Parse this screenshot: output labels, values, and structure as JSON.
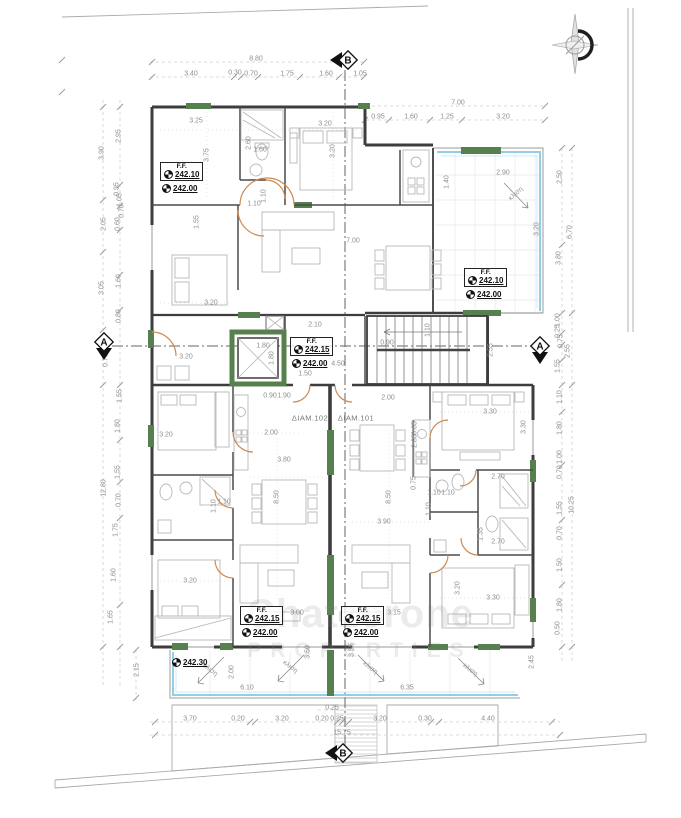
{
  "watermark": {
    "line1": "Chatzerone",
    "line2": "PROPERTIES"
  },
  "colors": {
    "wall": "#3d3d3d",
    "green_wall": "#57804f",
    "balcony_glass": "#8fd0e8",
    "door_arc": "#cc8a52",
    "dim_text": "#8d8d8d"
  },
  "section_markers": [
    {
      "label": "B",
      "x": 345,
      "y": 60,
      "dir": "left"
    },
    {
      "label": "B",
      "x": 340,
      "y": 753,
      "dir": "left"
    },
    {
      "label": "A",
      "x": 104,
      "y": 345,
      "dir": "down"
    },
    {
      "label": "A",
      "x": 540,
      "y": 349,
      "dir": "down"
    }
  ],
  "elevations": [
    {
      "title": "F.F.",
      "value": "242.10",
      "sub": "242.00",
      "x": 160,
      "y": 162
    },
    {
      "title": "F.F.",
      "value": "242.10",
      "sub": "242.00",
      "x": 464,
      "y": 268
    },
    {
      "title": "F.F.",
      "value": "242.15",
      "sub": "242.00",
      "x": 290,
      "y": 337
    },
    {
      "title": "F.F.",
      "value": "242.15",
      "sub": "242.00",
      "x": 240,
      "y": 606
    },
    {
      "title": "F.F.",
      "value": "242.15",
      "sub": "242.00",
      "x": 341,
      "y": 606
    },
    {
      "title": "",
      "value": "242.30",
      "sub": "",
      "x": 170,
      "y": 658
    }
  ],
  "slope_labels": [
    {
      "t": "κλιση",
      "x": 516,
      "y": 194,
      "r": -42
    },
    {
      "t": "κλιση",
      "x": 210,
      "y": 670,
      "r": 38
    },
    {
      "t": "κλιση",
      "x": 290,
      "y": 667,
      "r": 38
    },
    {
      "t": "κλιση",
      "x": 370,
      "y": 668,
      "r": 38
    },
    {
      "t": "κλιση",
      "x": 470,
      "y": 670,
      "r": 38
    }
  ],
  "labels": [
    {
      "t": "8.80",
      "x": 256,
      "y": 59
    },
    {
      "t": "3.40",
      "x": 191,
      "y": 74
    },
    {
      "t": "0.30",
      "x": 235,
      "y": 73
    },
    {
      "t": "0.70",
      "x": 251,
      "y": 74
    },
    {
      "t": "1.75",
      "x": 287,
      "y": 74
    },
    {
      "t": "1.60",
      "x": 326,
      "y": 74
    },
    {
      "t": "1.05",
      "x": 360,
      "y": 74
    },
    {
      "t": "7.00",
      "x": 458,
      "y": 103
    },
    {
      "t": "0.95",
      "x": 378,
      "y": 117
    },
    {
      "t": "1.60",
      "x": 411,
      "y": 117
    },
    {
      "t": "1.25",
      "x": 447,
      "y": 117
    },
    {
      "t": "3.20",
      "x": 503,
      "y": 117
    },
    {
      "t": "3.25",
      "x": 196,
      "y": 121
    },
    {
      "t": "3.75",
      "x": 207,
      "y": 155,
      "r": -90
    },
    {
      "t": "2.60",
      "x": 249,
      "y": 143,
      "r": -90
    },
    {
      "t": "1.60",
      "x": 260,
      "y": 150
    },
    {
      "t": "3.20",
      "x": 325,
      "y": 124
    },
    {
      "t": "3.20",
      "x": 333,
      "y": 151,
      "r": -90
    },
    {
      "t": "1.40",
      "x": 447,
      "y": 182,
      "r": -90
    },
    {
      "t": "2.90",
      "x": 503,
      "y": 173
    },
    {
      "t": "3.20",
      "x": 537,
      "y": 229,
      "r": -90
    },
    {
      "t": "7.00",
      "x": 353,
      "y": 241
    },
    {
      "t": "1.10",
      "x": 264,
      "y": 196,
      "r": -90
    },
    {
      "t": "1.10",
      "x": 254,
      "y": 204
    },
    {
      "t": "1.55",
      "x": 197,
      "y": 222,
      "r": -90
    },
    {
      "t": "2.10",
      "x": 315,
      "y": 325
    },
    {
      "t": "3.20",
      "x": 211,
      "y": 303
    },
    {
      "t": "1.80",
      "x": 263,
      "y": 346
    },
    {
      "t": "1.80",
      "x": 272,
      "y": 358,
      "r": -90
    },
    {
      "t": "3.20",
      "x": 186,
      "y": 357
    },
    {
      "t": "0.90",
      "x": 270,
      "y": 396
    },
    {
      "t": "1.90",
      "x": 284,
      "y": 396
    },
    {
      "t": "0.90",
      "x": 387,
      "y": 343
    },
    {
      "t": "4.50",
      "x": 338,
      "y": 364
    },
    {
      "t": "1.50",
      "x": 305,
      "y": 374
    },
    {
      "t": "2.00",
      "x": 388,
      "y": 398
    },
    {
      "t": "1.10",
      "x": 428,
      "y": 330,
      "r": -90
    },
    {
      "t": "2.55",
      "x": 491,
      "y": 350,
      "r": -90
    },
    {
      "t": "0.65",
      "x": 415,
      "y": 428,
      "r": -90
    },
    {
      "t": "ΔΙΑΜ.102",
      "x": 310,
      "y": 418,
      "c": "a"
    },
    {
      "t": "ΔΙΑΜ.101",
      "x": 356,
      "y": 418,
      "c": "a"
    },
    {
      "t": "2.00",
      "x": 271,
      "y": 433
    },
    {
      "t": "3.80",
      "x": 284,
      "y": 460
    },
    {
      "t": "8.50",
      "x": 277,
      "y": 497,
      "r": -90
    },
    {
      "t": "8.50",
      "x": 389,
      "y": 497,
      "r": -90
    },
    {
      "t": "3.90",
      "x": 384,
      "y": 522
    },
    {
      "t": "2.85",
      "x": 415,
      "y": 441,
      "r": -90
    },
    {
      "t": "0.75",
      "x": 414,
      "y": 483,
      "r": -90
    },
    {
      "t": "1.10",
      "x": 434,
      "y": 493
    },
    {
      "t": "1.10",
      "x": 429,
      "y": 509,
      "r": -90
    },
    {
      "t": "1.10",
      "x": 214,
      "y": 506,
      "r": -90
    },
    {
      "t": "1.10",
      "x": 224,
      "y": 502
    },
    {
      "t": "3.20",
      "x": 166,
      "y": 435
    },
    {
      "t": "3.30",
      "x": 490,
      "y": 412
    },
    {
      "t": "3.30",
      "x": 524,
      "y": 427,
      "r": -90
    },
    {
      "t": "2.70",
      "x": 498,
      "y": 477
    },
    {
      "t": "1.10",
      "x": 448,
      "y": 493
    },
    {
      "t": "1.35",
      "x": 481,
      "y": 534,
      "r": -90
    },
    {
      "t": "2.70",
      "x": 498,
      "y": 542
    },
    {
      "t": "3.20",
      "x": 458,
      "y": 588,
      "r": -90
    },
    {
      "t": "3.30",
      "x": 493,
      "y": 598
    },
    {
      "t": "3.20",
      "x": 190,
      "y": 581
    },
    {
      "t": "3.00",
      "x": 297,
      "y": 613
    },
    {
      "t": "3.15",
      "x": 394,
      "y": 613
    },
    {
      "t": "3.50",
      "x": 308,
      "y": 652,
      "r": -90
    },
    {
      "t": "3.55",
      "x": 352,
      "y": 650,
      "r": -90
    },
    {
      "t": "6.10",
      "x": 247,
      "y": 688
    },
    {
      "t": "6.35",
      "x": 407,
      "y": 688
    },
    {
      "t": "2.00",
      "x": 232,
      "y": 672,
      "r": -90
    },
    {
      "t": "2.15",
      "x": 137,
      "y": 670,
      "r": -90
    },
    {
      "t": "2.45",
      "x": 532,
      "y": 662,
      "r": -90
    },
    {
      "t": "0.25",
      "x": 332,
      "y": 708
    },
    {
      "t": "3.70",
      "x": 190,
      "y": 719
    },
    {
      "t": "0.20",
      "x": 238,
      "y": 719
    },
    {
      "t": "3.20",
      "x": 282,
      "y": 719
    },
    {
      "t": "0.20",
      "x": 322,
      "y": 719
    },
    {
      "t": "0.25",
      "x": 337,
      "y": 719
    },
    {
      "t": "3.20",
      "x": 380,
      "y": 719
    },
    {
      "t": "0.30",
      "x": 425,
      "y": 719
    },
    {
      "t": "4.40",
      "x": 488,
      "y": 719
    },
    {
      "t": "15.75",
      "x": 342,
      "y": 733
    },
    {
      "t": "2.95",
      "x": 119,
      "y": 136,
      "r": -90
    },
    {
      "t": "3.90",
      "x": 102,
      "y": 153,
      "r": -90
    },
    {
      "t": "0.95",
      "x": 117,
      "y": 189,
      "r": -90
    },
    {
      "t": "1.05",
      "x": 120,
      "y": 200,
      "r": -90
    },
    {
      "t": "0.70",
      "x": 122,
      "y": 211,
      "r": -90
    },
    {
      "t": "0.60",
      "x": 118,
      "y": 224,
      "r": -90
    },
    {
      "t": "2.05",
      "x": 104,
      "y": 224,
      "r": -90
    },
    {
      "t": "1.60",
      "x": 119,
      "y": 281,
      "r": -90
    },
    {
      "t": "3.05",
      "x": 102,
      "y": 288,
      "r": -90
    },
    {
      "t": "0.80",
      "x": 119,
      "y": 316,
      "r": -90
    },
    {
      "t": "0.70",
      "x": 106,
      "y": 360,
      "r": -90
    },
    {
      "t": "1.55",
      "x": 120,
      "y": 396,
      "r": -90
    },
    {
      "t": "1.80",
      "x": 118,
      "y": 426,
      "r": -90
    },
    {
      "t": "1.55",
      "x": 118,
      "y": 472,
      "r": -90
    },
    {
      "t": "0.70",
      "x": 119,
      "y": 500,
      "r": -90
    },
    {
      "t": "1.75",
      "x": 116,
      "y": 530,
      "r": -90
    },
    {
      "t": "1.60",
      "x": 114,
      "y": 575,
      "r": -90
    },
    {
      "t": "1.65",
      "x": 111,
      "y": 617,
      "r": -90
    },
    {
      "t": "12.80",
      "x": 104,
      "y": 488,
      "r": -90
    },
    {
      "t": "2.50",
      "x": 560,
      "y": 177,
      "r": -90
    },
    {
      "t": "6.70",
      "x": 570,
      "y": 232,
      "r": -90
    },
    {
      "t": "3.80",
      "x": 559,
      "y": 258,
      "r": -90
    },
    {
      "t": "1.00",
      "x": 558,
      "y": 320,
      "r": -90
    },
    {
      "t": "0.25",
      "x": 558,
      "y": 331,
      "r": -90
    },
    {
      "t": "0.75",
      "x": 561,
      "y": 341,
      "r": -90
    },
    {
      "t": "2.55",
      "x": 568,
      "y": 351,
      "r": -90
    },
    {
      "t": "1.55",
      "x": 558,
      "y": 366,
      "r": -90
    },
    {
      "t": "1.10",
      "x": 560,
      "y": 397,
      "r": -90
    },
    {
      "t": "1.80",
      "x": 560,
      "y": 428,
      "r": -90
    },
    {
      "t": "1.00",
      "x": 560,
      "y": 457,
      "r": -90
    },
    {
      "t": "0.70",
      "x": 560,
      "y": 472,
      "r": -90
    },
    {
      "t": "1.55",
      "x": 560,
      "y": 508,
      "r": -90
    },
    {
      "t": "10.25",
      "x": 572,
      "y": 505,
      "r": -90
    },
    {
      "t": "0.70",
      "x": 560,
      "y": 533,
      "r": -90
    },
    {
      "t": "1.50",
      "x": 560,
      "y": 565,
      "r": -90
    },
    {
      "t": "1.80",
      "x": 560,
      "y": 605,
      "r": -90
    },
    {
      "t": "0.50",
      "x": 558,
      "y": 628,
      "r": -90
    }
  ]
}
